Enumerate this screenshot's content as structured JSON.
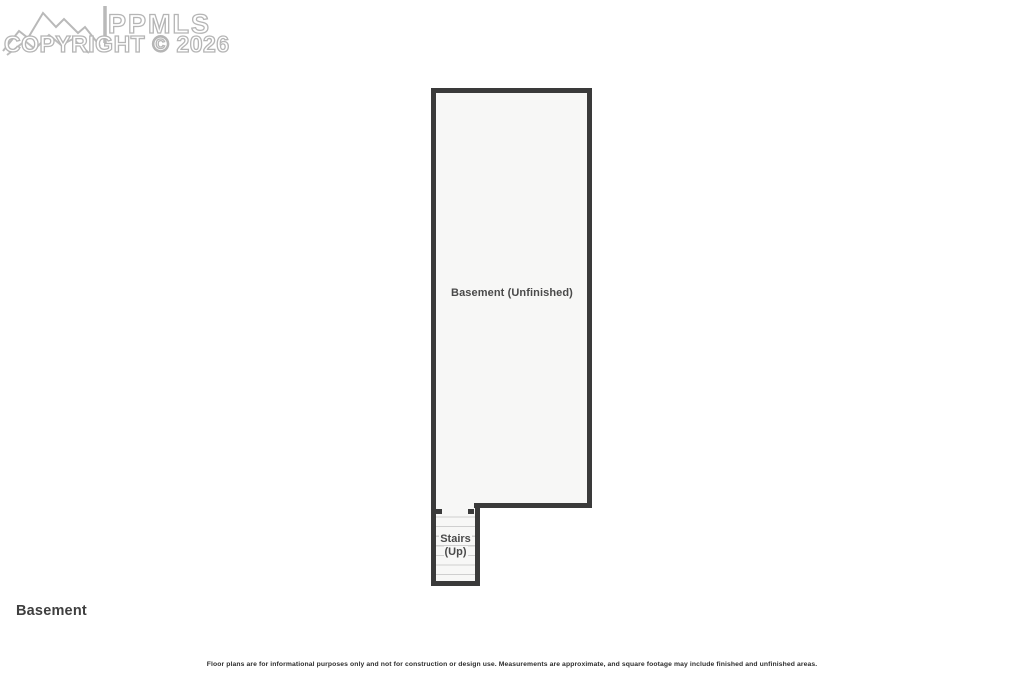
{
  "watermark": {
    "brand": "PPMLS",
    "copyright": "COPYRIGHT © 2026",
    "color": "#b5b5b5"
  },
  "floor_plan": {
    "room_label": "Basement (Unfinished)",
    "stairs_label_line1": "Stairs",
    "stairs_label_line2": "(Up)",
    "wall_color": "#3a3a3a",
    "floor_fill": "#f7f7f6",
    "tread_line_color": "#cfcfcf"
  },
  "footer": {
    "title": "Basement",
    "disclaimer": "Floor plans are for informational purposes only and not for construction or design use. Measurements are approximate, and square footage may include finished and unfinished areas."
  }
}
